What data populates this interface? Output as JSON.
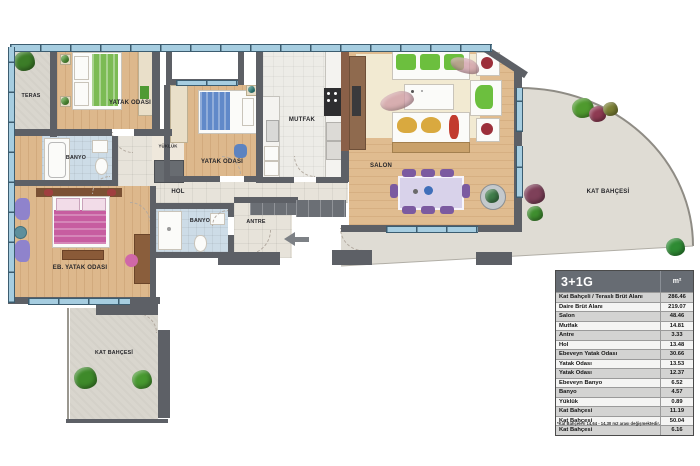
{
  "rooms": {
    "teras": "TERAS",
    "bedroom1": "YATAK ODASI",
    "bedroom2": "YATAK ODASI",
    "kitchen": "MUTFAK",
    "salon": "SALON",
    "hall": "HOL",
    "bathroom1": "BANYO",
    "bathroom2": "BANYO",
    "closet": "YÜKLÜK",
    "master_bedroom": "EB. YATAK ODASI",
    "entry": "ANTRE",
    "garden_right": "KAT BAHÇESİ",
    "garden_bottom": "KAT BAHÇESİ"
  },
  "table": {
    "title": "3+1G",
    "unit": "m²",
    "rows": [
      {
        "label": "Kat Bahçeli / Teraslı Brüt Alanı",
        "value": "286.46"
      },
      {
        "label": "Daire Brüt Alanı",
        "value": "219.07"
      },
      {
        "label": "Salon",
        "value": "48.46"
      },
      {
        "label": "Mutfak",
        "value": "14.81"
      },
      {
        "label": "Antre",
        "value": "3.33"
      },
      {
        "label": "Hol",
        "value": "13.48"
      },
      {
        "label": "Ebeveyn Yatak Odası",
        "value": "30.66"
      },
      {
        "label": "Yatak Odası",
        "value": "13.53"
      },
      {
        "label": "Yatak Odası",
        "value": "12.37"
      },
      {
        "label": "Ebeveyn Banyo",
        "value": "6.52"
      },
      {
        "label": "Banyo",
        "value": "4.57"
      },
      {
        "label": "Yüklük",
        "value": "0.89"
      },
      {
        "label": "Kat Bahçesi",
        "value": "11.19"
      },
      {
        "label": "Kat Bahçesi",
        "value": "50.04"
      },
      {
        "label": "Kat Bahçesi",
        "value": "6.16"
      }
    ],
    "footnote": "*Kat Bahçeleri 14,64 - 14,30 m2 arası değişmektedir."
  },
  "colors": {
    "wall": "#5d6066",
    "wood_floor": "#ddb88c",
    "concrete": "#d9d6ce",
    "facade_glass": "#a6cde0",
    "table_header": "#676c73",
    "bath_floor": "#cddce7"
  }
}
